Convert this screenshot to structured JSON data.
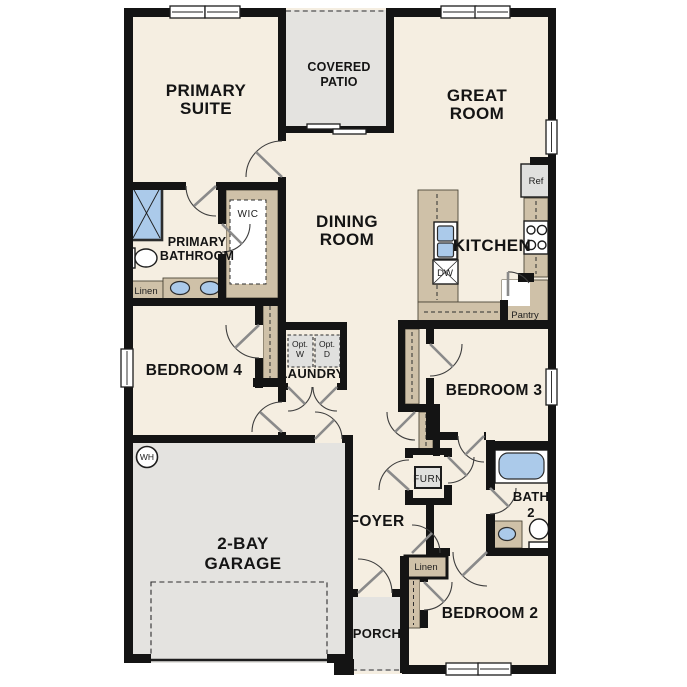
{
  "floor_plan": {
    "rooms": {
      "primary_suite": [
        "PRIMARY",
        "SUITE"
      ],
      "covered_patio": [
        "COVERED",
        "PATIO"
      ],
      "great_room": [
        "GREAT",
        "ROOM"
      ],
      "dining_room": [
        "DINING",
        "ROOM"
      ],
      "kitchen": [
        "KITCHEN"
      ],
      "primary_bathroom": [
        "PRIMARY",
        "BATHROOM"
      ],
      "wic": [
        "WIC"
      ],
      "laundry": [
        "LAUNDRY"
      ],
      "bedroom_4": [
        "BEDROOM 4"
      ],
      "bedroom_3": [
        "BEDROOM 3"
      ],
      "garage": [
        "2-BAY",
        "GARAGE"
      ],
      "foyer": [
        "FOYER"
      ],
      "bath_2": [
        "BATH",
        "2"
      ],
      "bedroom_2": [
        "BEDROOM 2"
      ],
      "porch": [
        "PORCH"
      ]
    },
    "fixtures": {
      "refrigerator": "Ref",
      "dishwasher": "DW",
      "pantry": "Pantry",
      "optional_washer": [
        "Opt.",
        "W"
      ],
      "optional_dryer": [
        "Opt.",
        "D"
      ],
      "linen_primary": "Linen",
      "linen_hall": "Linen",
      "water_heater": "WH",
      "furnace": "FURN"
    },
    "colors": {
      "floor": "#f5eee1",
      "wall": "#141414",
      "concrete": "#e4e3e0",
      "casework_tan": "#cfc1a8",
      "fixture_blue": "#abcaea",
      "appliance_gray": "#e0e0de",
      "page_background": "#ffffff"
    }
  }
}
